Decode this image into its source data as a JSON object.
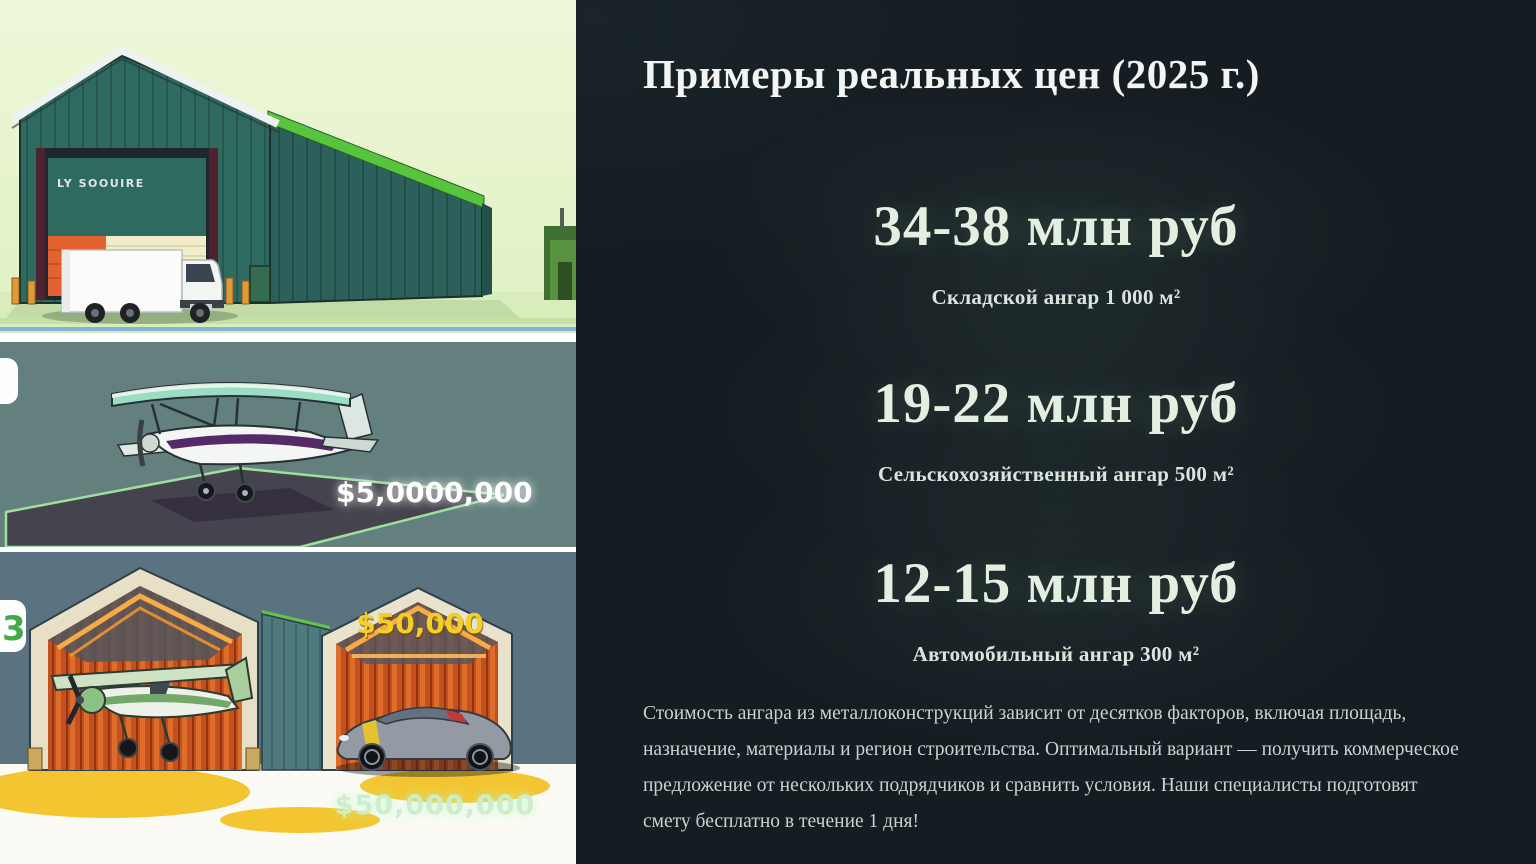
{
  "slide": {
    "title": "Примеры реальных цен (2025 г.)",
    "prices": [
      {
        "value": "34-38 млн руб",
        "label": "Складской ангар 1 000 м²"
      },
      {
        "value": "19-22 млн руб",
        "label": "Сельскохозяйственный ангар 500 м²"
      },
      {
        "value": "12-15 млн руб",
        "label": "Автомобильный ангар 300 м²"
      }
    ],
    "footer_note": "Стоимость ангара из металлоконструкций зависит от десятков факторов, включая площадь, назначение, материалы и регион строительства. Оптимальный вариант — получить коммерческое предложение от нескольких подрядчиков и сравнить условия. Наши специалисты подготовят смету бесплатно в течение 1 дня!"
  },
  "illustrations": {
    "warehouse": {
      "sign_text": "LY SOOUIRE"
    },
    "airplane": {
      "price_tag": "$5,0000,000"
    },
    "garage": {
      "price_tag_car": "$50,000",
      "price_tag_bottom": "$50,000,000",
      "badge": "3"
    }
  },
  "colors": {
    "panel_background": "#151c22",
    "title_text": "#f2f5f3",
    "price_text": "#e3efe1",
    "body_text": "#ccd3cf",
    "tag_white": "#ffffff",
    "tag_yellow": "#f3cf2a",
    "tag_mint": "#cfeccd",
    "hangar_green": "#2f6a60",
    "interior_orange": "#c2511f"
  }
}
